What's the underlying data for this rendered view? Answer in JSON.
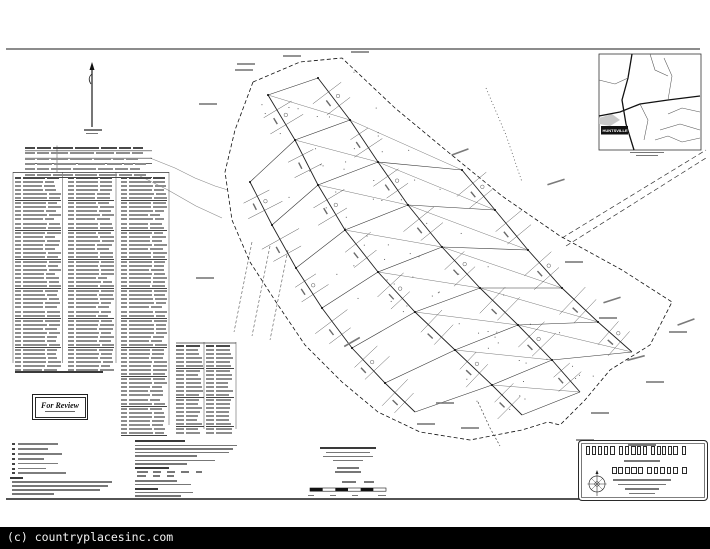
{
  "watermark": {
    "text": "(c) countryplacesinc.com"
  },
  "stamp": {
    "label": "For Review"
  },
  "vicinity": {
    "town_label": "HUNTSVILLE"
  },
  "colors": {
    "ink": "#1a1a1a",
    "road": "#222222",
    "lattice": "#444444",
    "faint_text": "#777777",
    "strip_bg": "#000000",
    "strip_text": "#f2f2f2"
  },
  "drawing": {
    "border_top": [
      6,
      49,
      700,
      49
    ],
    "sheet_bottom": [
      6,
      499,
      706,
      499
    ],
    "north_arrow": {
      "x": 92,
      "y_top": 62,
      "y_bot": 127
    },
    "spines": [
      [
        [
          268,
          95
        ],
        [
          295,
          140
        ],
        [
          318,
          185
        ],
        [
          345,
          230
        ],
        [
          378,
          272
        ],
        [
          415,
          312
        ],
        [
          455,
          350
        ],
        [
          492,
          385
        ],
        [
          522,
          415
        ]
      ],
      [
        [
          318,
          78
        ],
        [
          350,
          120
        ],
        [
          378,
          162
        ],
        [
          408,
          205
        ],
        [
          442,
          247
        ],
        [
          480,
          288
        ],
        [
          518,
          325
        ],
        [
          552,
          360
        ],
        [
          580,
          392
        ]
      ],
      [
        null,
        null,
        [
          462,
          170
        ],
        [
          495,
          210
        ],
        [
          528,
          250
        ],
        [
          562,
          288
        ],
        [
          598,
          322
        ],
        [
          632,
          352
        ],
        null
      ],
      [
        null,
        [
          250,
          182
        ],
        [
          272,
          225
        ],
        [
          296,
          268
        ],
        [
          322,
          308
        ],
        [
          352,
          348
        ],
        [
          385,
          383
        ],
        [
          415,
          412
        ],
        null
      ]
    ],
    "boundary_west": [
      [
        253,
        82
      ],
      [
        235,
        130
      ],
      [
        225,
        172
      ],
      [
        232,
        220
      ],
      [
        250,
        262
      ],
      [
        278,
        305
      ],
      [
        305,
        345
      ],
      [
        342,
        382
      ],
      [
        378,
        412
      ],
      [
        420,
        432
      ],
      [
        470,
        440
      ],
      [
        522,
        430
      ],
      [
        548,
        422
      ]
    ],
    "boundary_east": [
      [
        253,
        82
      ],
      [
        300,
        62
      ],
      [
        342,
        58
      ],
      [
        395,
        108
      ],
      [
        448,
        152
      ],
      [
        502,
        196
      ],
      [
        560,
        236
      ],
      [
        622,
        270
      ],
      [
        672,
        302
      ],
      [
        650,
        345
      ],
      [
        610,
        370
      ],
      [
        585,
        400
      ],
      [
        560,
        425
      ],
      [
        548,
        422
      ]
    ],
    "spur_ne": [
      [
        [
          562,
          238
        ],
        [
          706,
          150
        ]
      ],
      [
        [
          566,
          246
        ],
        [
          706,
          158
        ]
      ]
    ],
    "spur_dots": [
      [
        486,
        88
      ],
      [
        506,
        135
      ],
      [
        522,
        182
      ]
    ],
    "tail": [
      [
        478,
        402
      ],
      [
        490,
        428
      ],
      [
        500,
        446
      ]
    ],
    "creeks": [
      [
        [
          150,
          158
        ],
        [
          175,
          168
        ],
        [
          195,
          178
        ],
        [
          215,
          186
        ],
        [
          228,
          190
        ]
      ],
      [
        [
          140,
          176
        ],
        [
          168,
          190
        ],
        [
          196,
          206
        ],
        [
          222,
          218
        ]
      ]
    ],
    "easement_lines": [
      [
        [
          252,
          242
        ],
        [
          234,
          332
        ]
      ],
      [
        [
          270,
          246
        ],
        [
          252,
          336
        ]
      ],
      [
        [
          288,
          250
        ],
        [
          270,
          340
        ]
      ]
    ],
    "inset": {
      "x": 599,
      "y": 54,
      "w": 102,
      "h": 96
    },
    "inset_roads_major": [
      [
        [
          599,
          116
        ],
        [
          620,
          112
        ],
        [
          640,
          104
        ],
        [
          668,
          100
        ],
        [
          700,
          96
        ]
      ],
      [
        [
          632,
          54
        ],
        [
          628,
          78
        ],
        [
          622,
          100
        ],
        [
          626,
          124
        ],
        [
          634,
          150
        ]
      ]
    ],
    "inset_roads_minor": [
      [
        [
          599,
          80
        ],
        [
          615,
          84
        ],
        [
          628,
          78
        ]
      ],
      [
        [
          640,
          104
        ],
        [
          648,
          120
        ],
        [
          644,
          140
        ]
      ],
      [
        [
          668,
          100
        ],
        [
          672,
          76
        ],
        [
          664,
          58
        ]
      ],
      [
        [
          660,
          130
        ],
        [
          680,
          124
        ],
        [
          700,
          130
        ]
      ],
      [
        [
          650,
          54
        ],
        [
          655,
          70
        ],
        [
          668,
          76
        ]
      ],
      [
        [
          700,
          112
        ],
        [
          682,
          108
        ],
        [
          668,
          114
        ]
      ],
      [
        [
          655,
          140
        ],
        [
          668,
          136
        ],
        [
          682,
          142
        ],
        [
          700,
          138
        ]
      ]
    ],
    "shoreline": [
      [
        599,
        118
      ],
      [
        612,
        114
      ],
      [
        620,
        120
      ],
      [
        610,
        126
      ],
      [
        599,
        124
      ]
    ],
    "town_box": {
      "x": 601,
      "y": 126,
      "w": 27,
      "h": 8.5
    },
    "compass": {
      "cx": 597,
      "cy": 484,
      "r": 8
    },
    "scale_bar": {
      "x": 310,
      "y": 488,
      "w": 76,
      "h": 3.2,
      "segments": 6
    },
    "table_vlines": [
      [
        13,
        172,
        363
      ],
      [
        62.5,
        172,
        363
      ],
      [
        116,
        172,
        363
      ],
      [
        169,
        172,
        425
      ],
      [
        204,
        342,
        429
      ],
      [
        236,
        342,
        429
      ],
      [
        57,
        145.5,
        172
      ]
    ],
    "table_hlines": [
      [
        13,
        169,
        172.5
      ],
      [
        176,
        236,
        343
      ],
      [
        25,
        152,
        150.8
      ],
      [
        25,
        152,
        158.2
      ],
      [
        25,
        152,
        163.4
      ]
    ],
    "callouts": [
      [
        460,
        152,
        -20
      ],
      [
        556,
        182,
        -18
      ],
      [
        574,
        262,
        0
      ],
      [
        608,
        318,
        0
      ],
      [
        636,
        358,
        -15
      ],
      [
        600,
        413,
        0
      ],
      [
        426,
        424,
        0
      ],
      [
        352,
        342,
        -30
      ],
      [
        208,
        104,
        0
      ],
      [
        244,
        70,
        0
      ],
      [
        585,
        440,
        0
      ],
      [
        612,
        300,
        -18
      ],
      [
        205,
        278,
        0
      ],
      [
        470,
        428,
        0
      ],
      [
        445,
        403,
        0
      ],
      [
        678,
        332,
        0
      ],
      [
        292,
        56,
        0
      ],
      [
        246,
        64,
        0
      ],
      [
        360,
        52,
        0
      ],
      [
        686,
        322,
        -20
      ],
      [
        655,
        382,
        0
      ]
    ]
  },
  "tables": {
    "curve_table": {
      "x": 25,
      "y": 145.5,
      "w": 127,
      "rows": 5,
      "row_h": 5.3,
      "cols": [
        10,
        14,
        20,
        24,
        16,
        12,
        10
      ],
      "header": true
    },
    "groups": [
      {
        "x": 15,
        "y": 176,
        "w": 46,
        "rows": 46,
        "row_h": 4.05,
        "cols": [
          6,
          22,
          12
        ],
        "header": true
      },
      {
        "x": 68,
        "y": 176,
        "w": 46,
        "rows": 46,
        "row_h": 4.05,
        "cols": [
          6,
          22,
          12
        ],
        "header": true
      },
      {
        "x": 121,
        "y": 176,
        "w": 46,
        "rows": 61,
        "row_h": 4.05,
        "cols": [
          6,
          22,
          12
        ],
        "header": true
      },
      {
        "x": 176,
        "y": 344,
        "w": 28,
        "rows": 21,
        "row_h": 4.0,
        "cols": [
          8,
          14
        ],
        "header": true
      },
      {
        "x": 206,
        "y": 344,
        "w": 28,
        "rows": 21,
        "row_h": 4.0,
        "cols": [
          8,
          14
        ],
        "header": true
      }
    ],
    "heavy_every": 7
  },
  "legend": {
    "x": 10,
    "y": 443,
    "step": 4.9,
    "item_widths": [
      40,
      30,
      44,
      26,
      40,
      28,
      48
    ]
  },
  "bars": [
    [
      84,
      129,
      18,
      1.8,
      0
    ],
    [
      86,
      132.5,
      12,
      1.4,
      0
    ],
    [
      15,
      371,
      88,
      2.2,
      1
    ],
    [
      10,
      477,
      13,
      2.2,
      1
    ],
    [
      12,
      481,
      100,
      1.6,
      0
    ],
    [
      12,
      485,
      96,
      1.6,
      0
    ],
    [
      12,
      489,
      88,
      1.6,
      0
    ],
    [
      12,
      493,
      42,
      1.6,
      0
    ],
    [
      135,
      440,
      50,
      2.4,
      1
    ],
    [
      135,
      444.5,
      102,
      1.6,
      0
    ],
    [
      135,
      448,
      98,
      1.6,
      0
    ],
    [
      135,
      451.5,
      94,
      1.6,
      0
    ],
    [
      135,
      455,
      62,
      1.6,
      0
    ],
    [
      135,
      459.5,
      80,
      1.6,
      0
    ],
    [
      135,
      463,
      52,
      1.6,
      0
    ],
    [
      135,
      466.8,
      34,
      2.2,
      1
    ],
    [
      137,
      471,
      11,
      1.7,
      0
    ],
    [
      153,
      471,
      8,
      1.7,
      0
    ],
    [
      167,
      471,
      8,
      1.7,
      0
    ],
    [
      181,
      471,
      8,
      1.7,
      0
    ],
    [
      196,
      471,
      6,
      1.7,
      0
    ],
    [
      137,
      475,
      9,
      1.5,
      0
    ],
    [
      153,
      475,
      7,
      1.5,
      0
    ],
    [
      167,
      475,
      7,
      1.5,
      0
    ],
    [
      135,
      480,
      42,
      1.6,
      0
    ],
    [
      135,
      483.5,
      56,
      1.6,
      0
    ],
    [
      135,
      488,
      23,
      2,
      1
    ],
    [
      135,
      491.5,
      58,
      1.5,
      0
    ],
    [
      135,
      495,
      46,
      1.5,
      0
    ],
    [
      320,
      447,
      56,
      2.2,
      1
    ],
    [
      326,
      451.5,
      44,
      1.7,
      0
    ],
    [
      323,
      455.5,
      50,
      1.7,
      0
    ],
    [
      333,
      459.5,
      30,
      1.7,
      0
    ],
    [
      337,
      467,
      22,
      1.5,
      0
    ],
    [
      335,
      471,
      26,
      1.5,
      0
    ],
    [
      628,
      444,
      28,
      1.8,
      0
    ],
    [
      624,
      459.5,
      36,
      2,
      0
    ],
    [
      613,
      479,
      58,
      1.8,
      0
    ],
    [
      618,
      483.8,
      48,
      1.6,
      0
    ],
    [
      625,
      488.4,
      34,
      1.6,
      0
    ],
    [
      629,
      492.6,
      26,
      1.5,
      0
    ],
    [
      630,
      151.5,
      34,
      1.8,
      0
    ],
    [
      636,
      155,
      22,
      1.4,
      0
    ],
    [
      342,
      481,
      14,
      1.6,
      0
    ],
    [
      364,
      481,
      10,
      1.6,
      0
    ],
    [
      308,
      494.5,
      6,
      1.4,
      0
    ],
    [
      330,
      494.5,
      6,
      1.4,
      0
    ],
    [
      352,
      494.5,
      6,
      1.4,
      0
    ],
    [
      378,
      494.5,
      8,
      1.4,
      0
    ]
  ],
  "title_blobs": [
    {
      "x": 586,
      "y": 446,
      "w": 102,
      "h": 9
    },
    {
      "x": 612,
      "y": 467,
      "w": 76,
      "h": 6.5
    }
  ]
}
